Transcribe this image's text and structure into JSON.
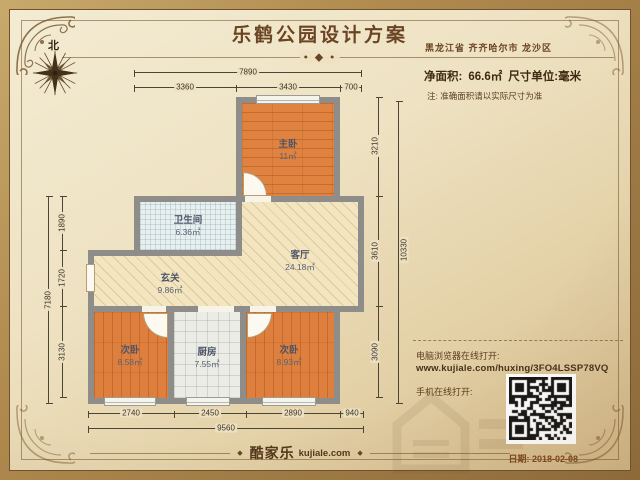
{
  "header": {
    "title": "乐鹤公园设计方案",
    "location": "黑龙江省 齐齐哈尔市 龙沙区",
    "divider_ornament": "• ◆ •",
    "north_label": "北"
  },
  "info": {
    "area_label": "净面积:",
    "area_value": "66.6㎡",
    "unit_label": "尺寸单位:毫米",
    "note": "注: 准确面积请以实际尺寸为准"
  },
  "rooms": [
    {
      "name": "主卧",
      "area": "11㎡"
    },
    {
      "name": "卫生间",
      "area": "6.36㎡"
    },
    {
      "name": "客厅",
      "area": "24.18㎡"
    },
    {
      "name": "玄关",
      "area": "9.86㎡"
    },
    {
      "name": "次卧",
      "area": "8.58㎡"
    },
    {
      "name": "厨房",
      "area": "7.55㎡"
    },
    {
      "name": "次卧",
      "area": "8.93㎡"
    }
  ],
  "dimensions": {
    "top_total": "7890",
    "top_segments": [
      "3360",
      "3430",
      "700"
    ],
    "left_total": "7180",
    "left_segments": [
      "1890",
      "1720",
      "3130"
    ],
    "right_total": "10330",
    "right_segments": [
      "3210",
      "3610",
      "3090"
    ],
    "bottom_total": "9560",
    "bottom_segments": [
      "2740",
      "2450",
      "2890",
      "940"
    ]
  },
  "share": {
    "pc_label": "电脑浏览器在线打开:",
    "url": "www.kujiale.com/huxing/3FO4LSSP78VQ",
    "mobile_label": "手机在线打开:"
  },
  "footer": {
    "brand": "酷家乐",
    "brand_site": "kujiale.com",
    "bullet": "◆",
    "date": "日期: 2018-02-08"
  }
}
